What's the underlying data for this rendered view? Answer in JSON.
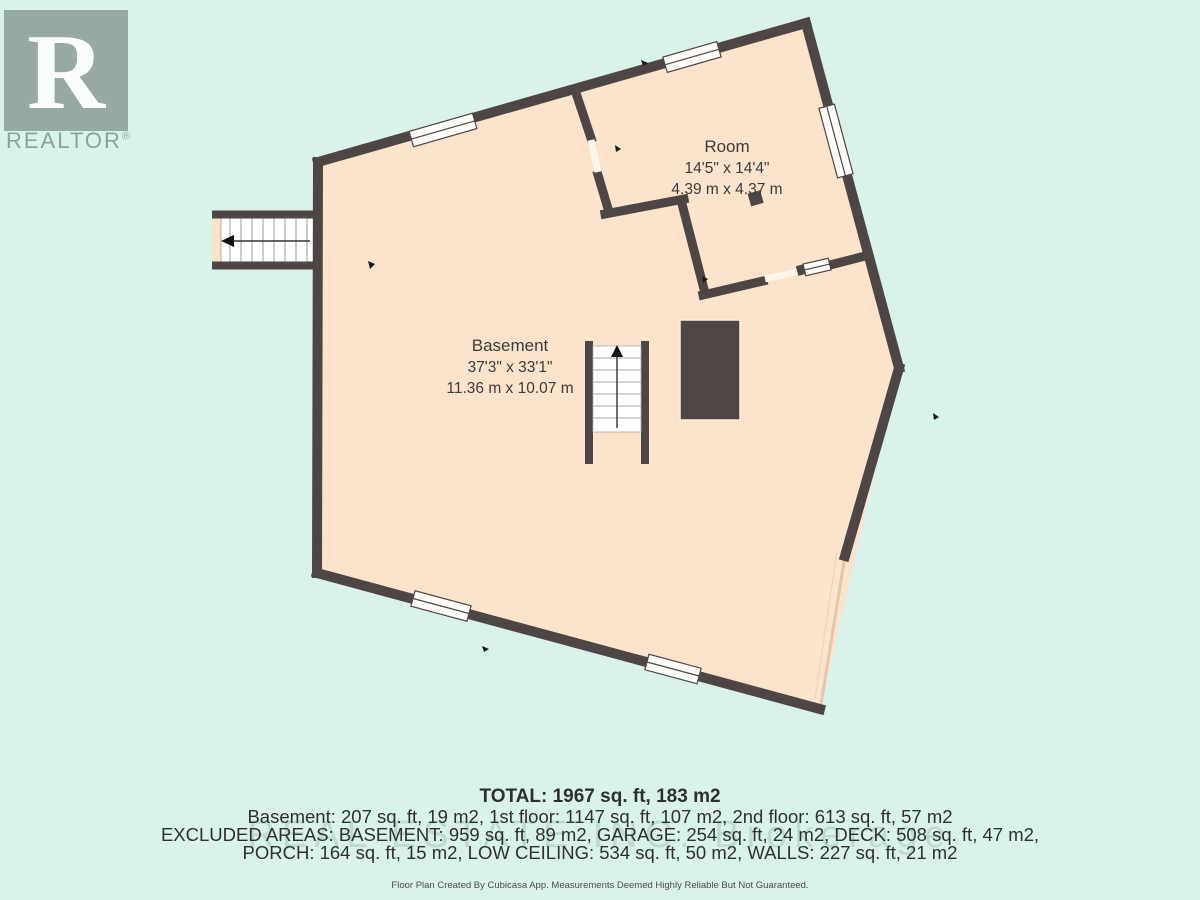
{
  "logo": {
    "letter": "R",
    "label": "REALTOR",
    "reg": "®",
    "icon": "realtor-logo-icon"
  },
  "plan": {
    "rooms": [
      {
        "name": "Room",
        "dim_ft": "14'5\" x 14'4\"",
        "dim_m": "4.39 m x 4.37 m"
      },
      {
        "name": "Basement",
        "dim_ft": "37'3\" x 33'1\"",
        "dim_m": "11.36 m x 10.07 m"
      }
    ],
    "icons": {
      "stairs_up": "stairs-up-arrow-icon",
      "stairs_exit": "stairs-exit-arrow-icon",
      "door_mark": "door-swing-mark-icon"
    }
  },
  "summary": {
    "total": "TOTAL: 1967 sq. ft, 183 m2",
    "floors": "Basement: 207 sq. ft, 19 m2, 1st floor: 1147 sq. ft, 107 m2, 2nd floor: 613 sq. ft, 57 m2",
    "excluded_1": "EXCLUDED AREAS: BASEMENT: 959 sq. ft, 89 m2, GARAGE: 254 sq. ft, 24 m2, DECK: 508 sq. ft, 47 m2,",
    "excluded_2": "PORCH: 164 sq. ft, 15 m2, LOW CEILING: 534 sq. ft, 50 m2, WALLS: 227 sq. ft, 21 m2"
  },
  "watermark": "REAL ESTATE INC. Brokerage",
  "footer": "Floor Plan Created By Cubicasa App. Measurements Deemed Highly Reliable But Not Guaranteed.",
  "colors": {
    "background": "#d9f3ea",
    "floor": "#fce3cb",
    "wall": "#4e4644",
    "text": "#3c3c3c",
    "logo_gray": "#97a9a3",
    "open_edge": "#e3c6ab"
  }
}
